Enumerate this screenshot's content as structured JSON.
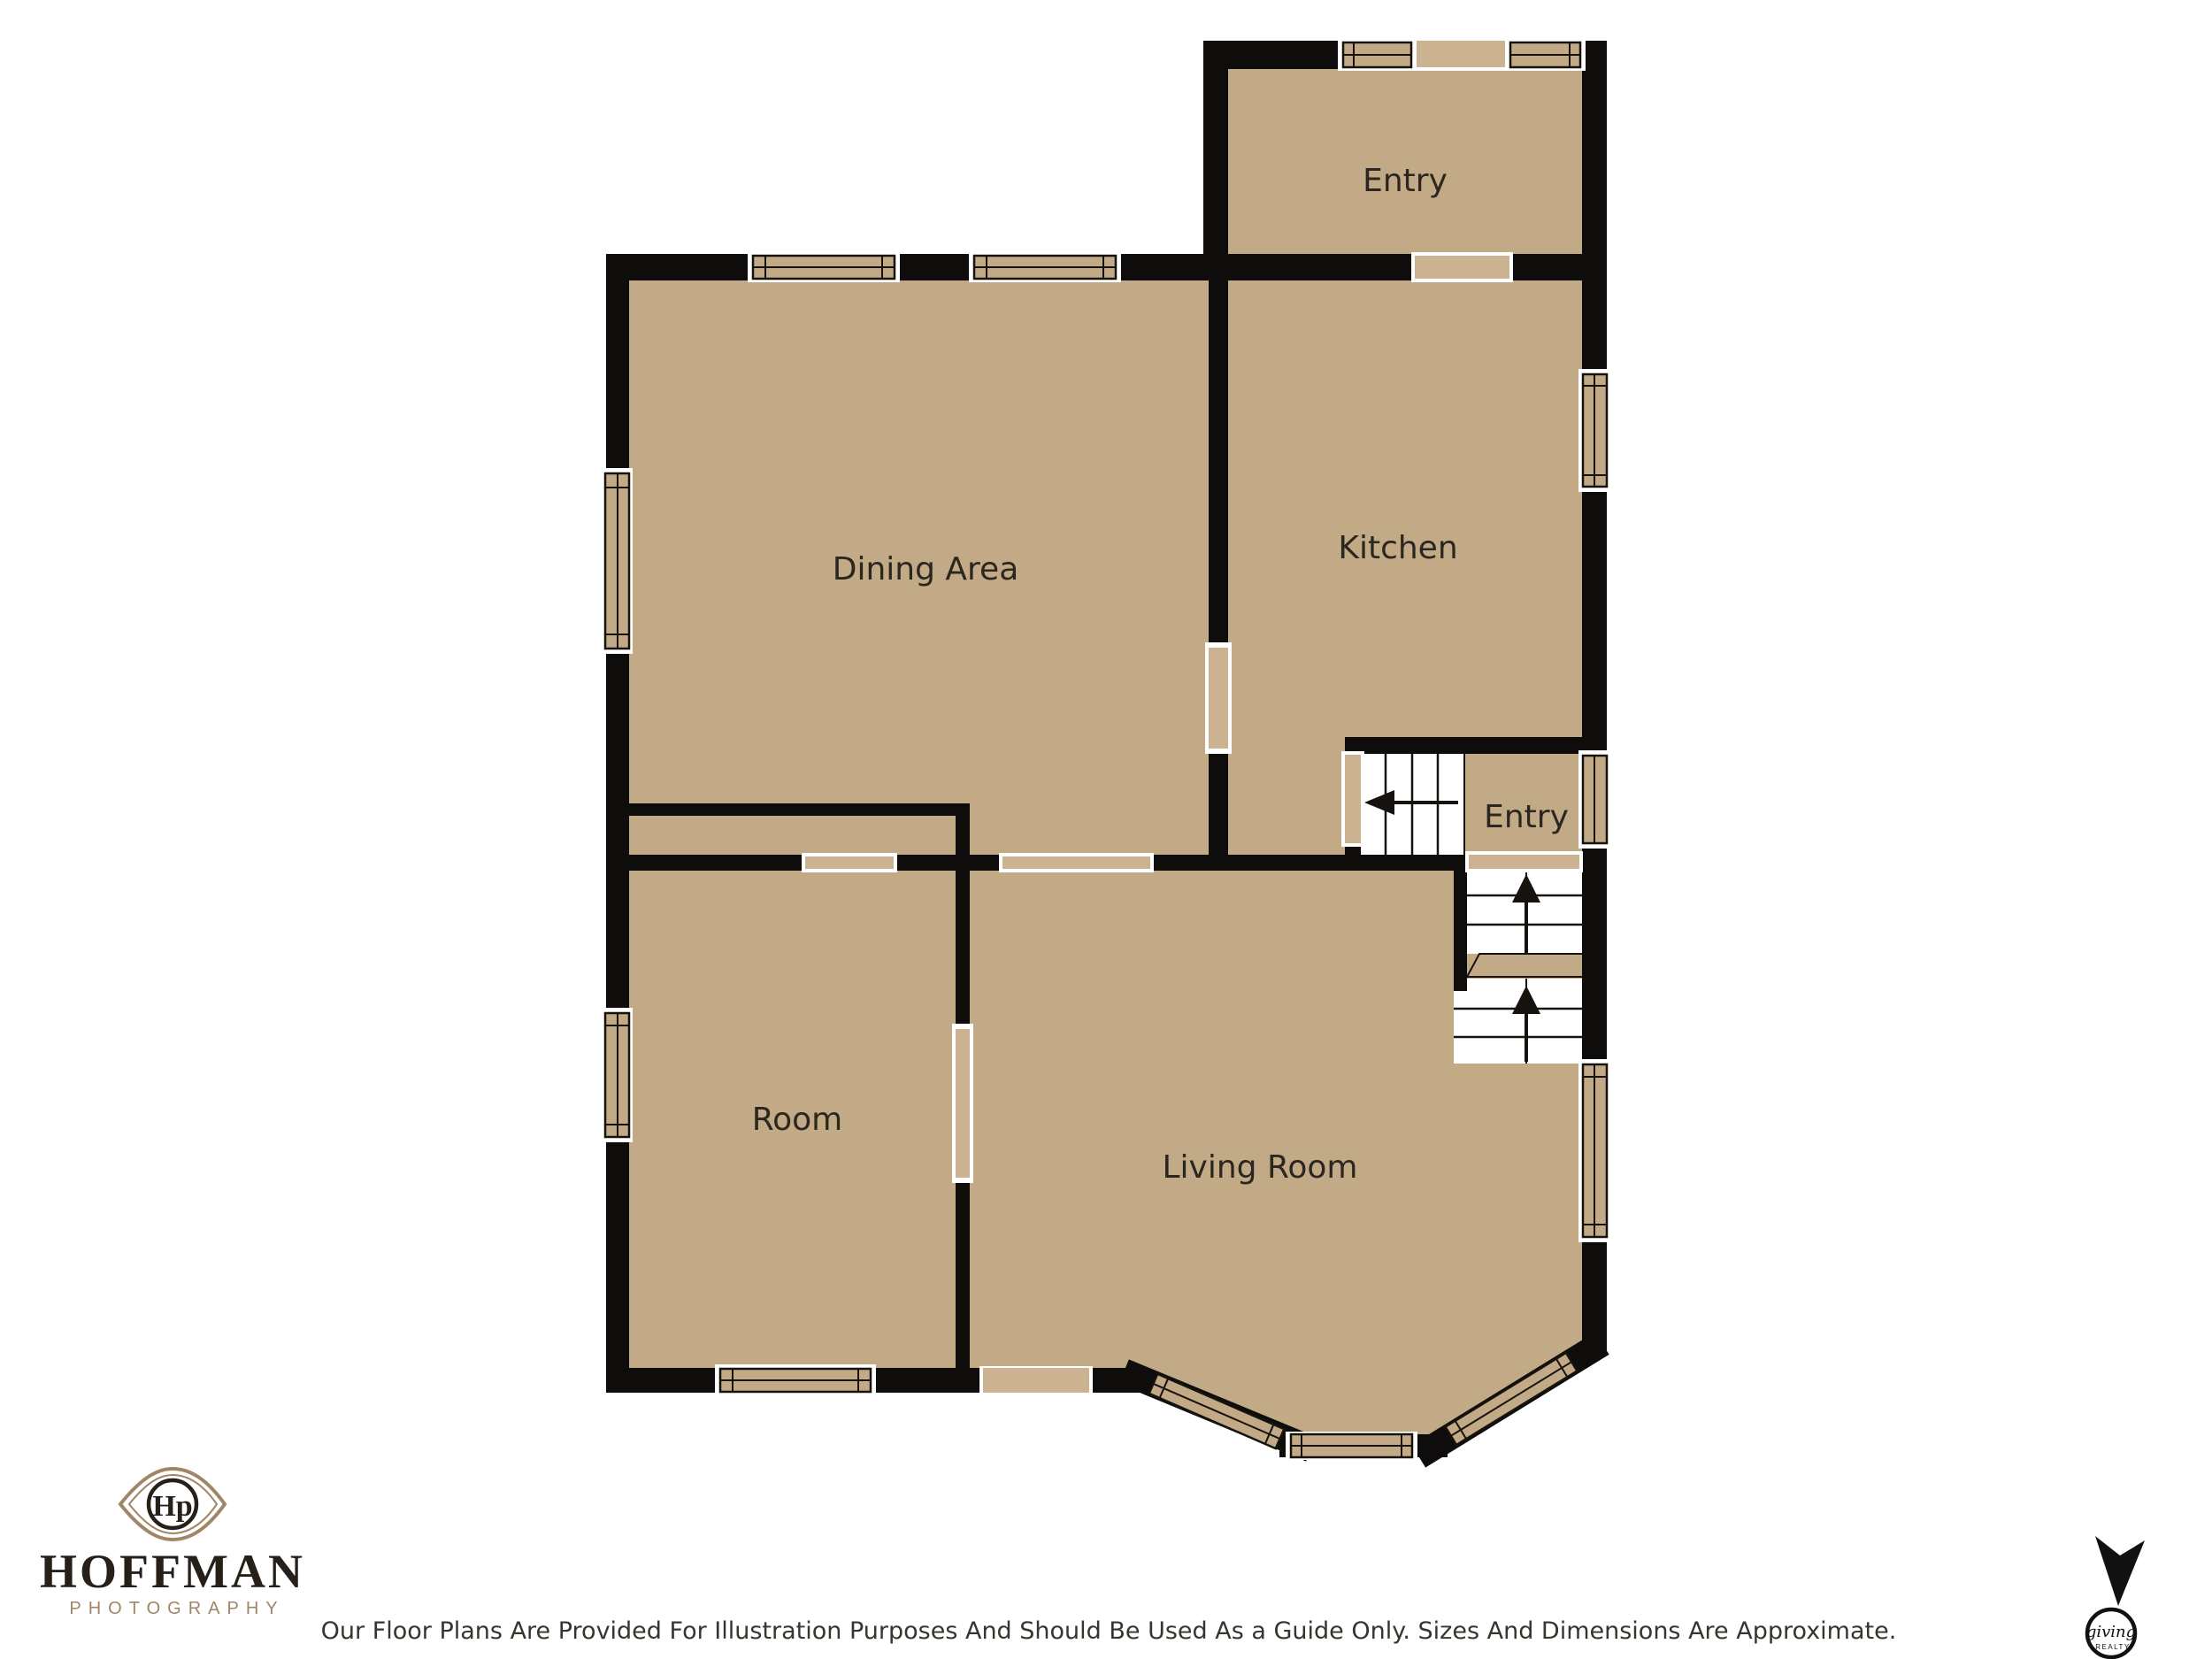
{
  "title": "Floor Plan",
  "floor_plan": {
    "colors": {
      "floor": "#c3aa86",
      "wall": "#0e0d0b",
      "door_fill": "#cbb291",
      "label": "#2b261f"
    },
    "rooms": [
      {
        "id": "entry_top",
        "label": "Entry"
      },
      {
        "id": "dining_area",
        "label": "Dining Area"
      },
      {
        "id": "kitchen",
        "label": "Kitchen"
      },
      {
        "id": "entry_mid",
        "label": "Entry"
      },
      {
        "id": "room",
        "label": "Room"
      },
      {
        "id": "living_room",
        "label": "Living Room"
      }
    ]
  },
  "branding": {
    "monogram": "Hp",
    "name": "HOFFMAN",
    "subtitle": "PHOTOGRAPHY",
    "badge": {
      "script": "giving",
      "caps": "REALTY"
    }
  },
  "footer": {
    "disclaimer": "Our Floor Plans Are Provided For Illustration Purposes And Should Be Used As a Guide Only. Sizes And Dimensions Are Approximate."
  }
}
